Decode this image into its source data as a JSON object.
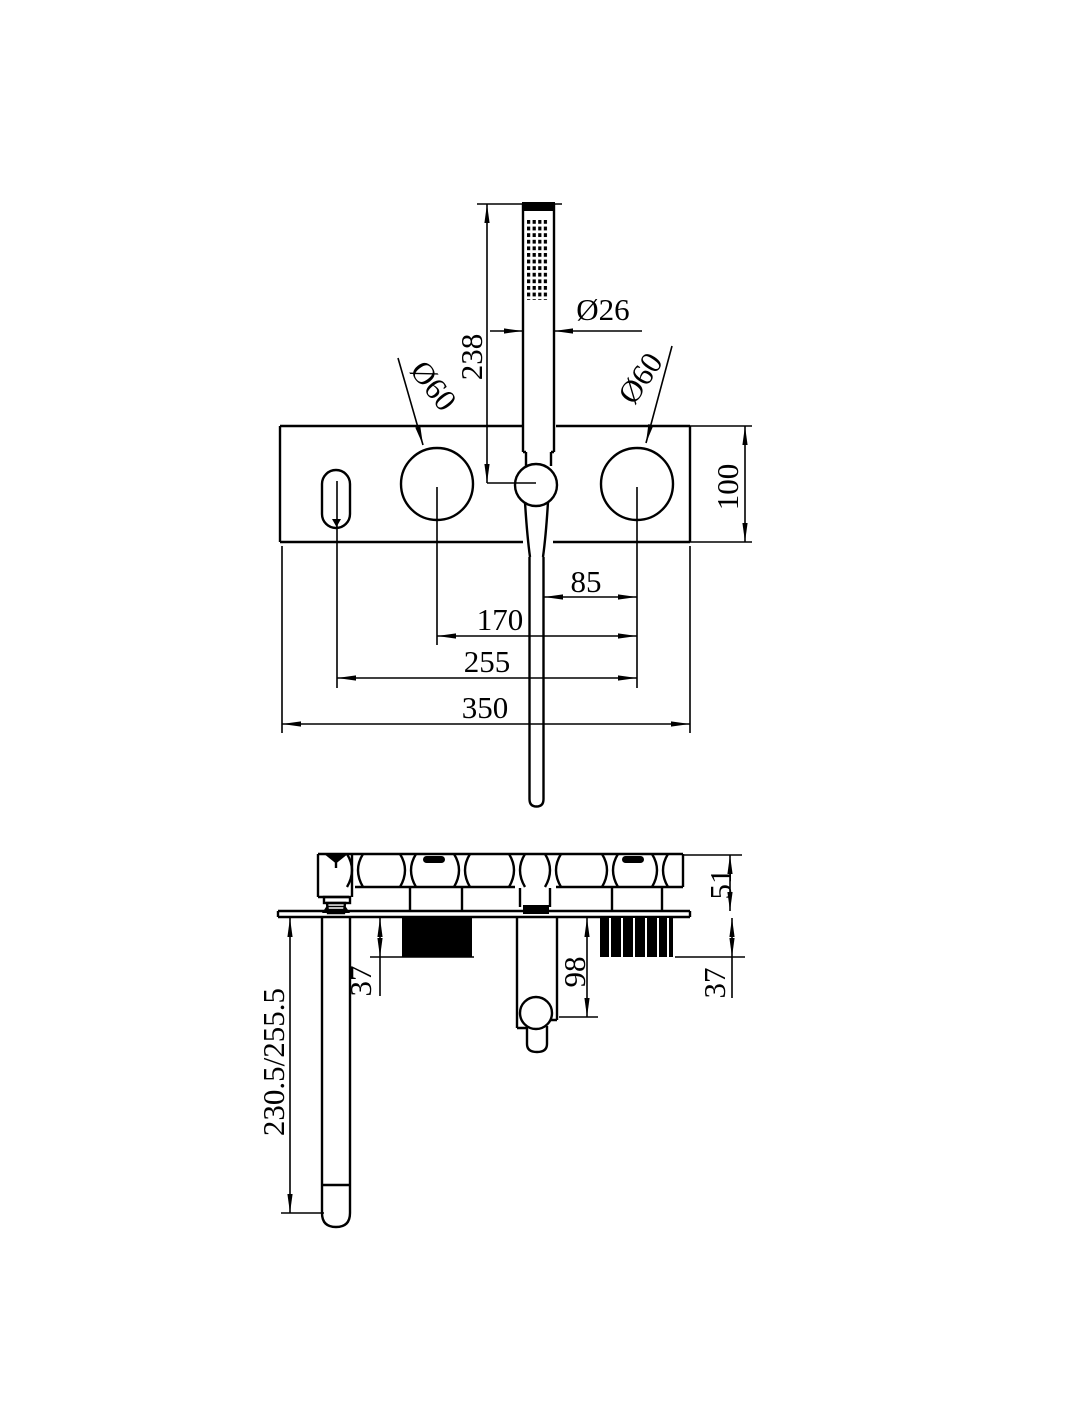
{
  "front_view": {
    "handshower_length": "238",
    "handshower_diameter": "Ø26",
    "left_handle_diameter": "Ø60",
    "right_handle_diameter": "Ø60",
    "plate_height": "100",
    "hose_to_right_handle": "85",
    "handle_spacing": "170",
    "spout_to_right_handle": "255",
    "plate_width": "350"
  },
  "side_view": {
    "body_projection": "51",
    "left_valve_depth": "37",
    "hose_drop": "98",
    "right_valve_depth": "37",
    "spout_reach": "230.5/255.5"
  }
}
